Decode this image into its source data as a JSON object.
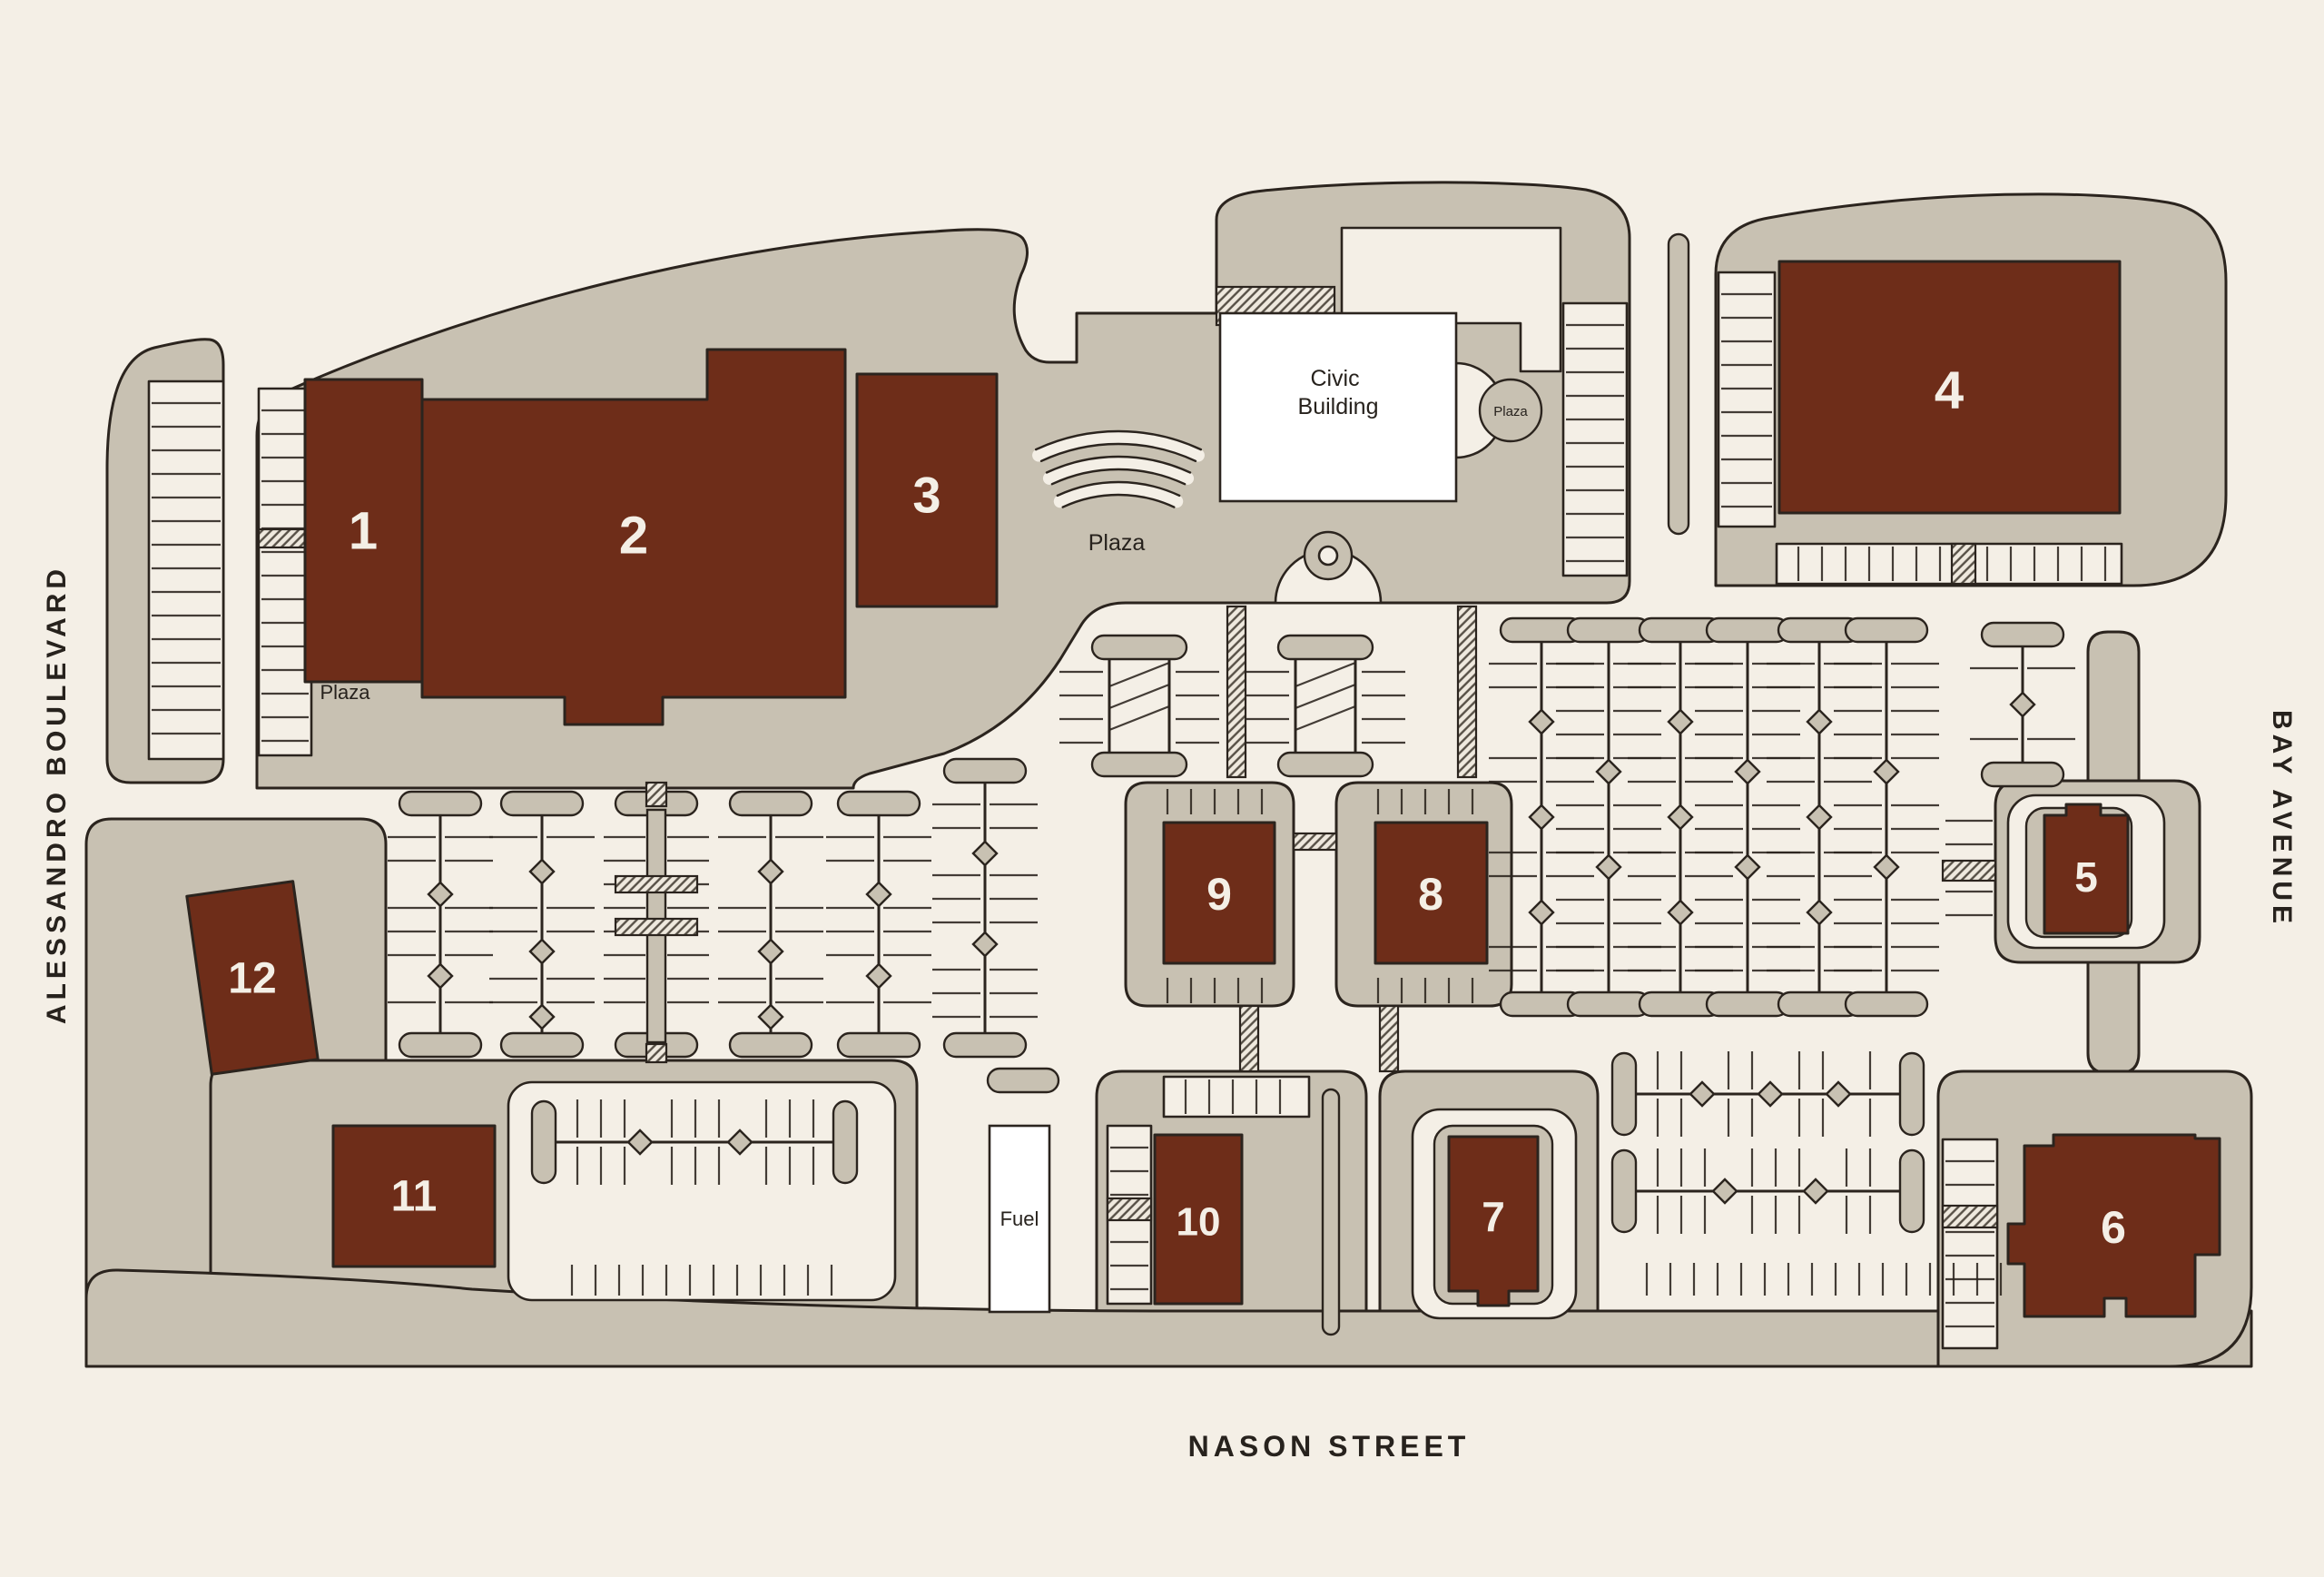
{
  "streets": {
    "west": {
      "label": "ALESSANDRO BOULEVARD"
    },
    "east": {
      "label": "BAY AVENUE"
    },
    "south": {
      "label": "NASON STREET"
    }
  },
  "buildings": [
    {
      "id": 1,
      "label": "1"
    },
    {
      "id": 2,
      "label": "2"
    },
    {
      "id": 3,
      "label": "3"
    },
    {
      "id": 4,
      "label": "4"
    },
    {
      "id": 5,
      "label": "5"
    },
    {
      "id": 6,
      "label": "6"
    },
    {
      "id": 7,
      "label": "7"
    },
    {
      "id": 8,
      "label": "8"
    },
    {
      "id": 9,
      "label": "9"
    },
    {
      "id": 10,
      "label": "10"
    },
    {
      "id": 11,
      "label": "11"
    },
    {
      "id": 12,
      "label": "12"
    }
  ],
  "civic_building": {
    "label": "Civic Building",
    "lines": [
      "Civic",
      "Building"
    ]
  },
  "plaza": {
    "pad_label": "Plaza",
    "amphitheater_label": "Plaza",
    "circle_label": "Plaza"
  },
  "fuel": {
    "label": "Fuel"
  },
  "colors": {
    "background": "#F4EFE6",
    "pad": "#C8C1B2",
    "building": "#6E2D19",
    "outline": "#2B241E",
    "white": "#FFFFFF",
    "number_text": "#F4EFE6",
    "dark_text": "#27221D"
  }
}
